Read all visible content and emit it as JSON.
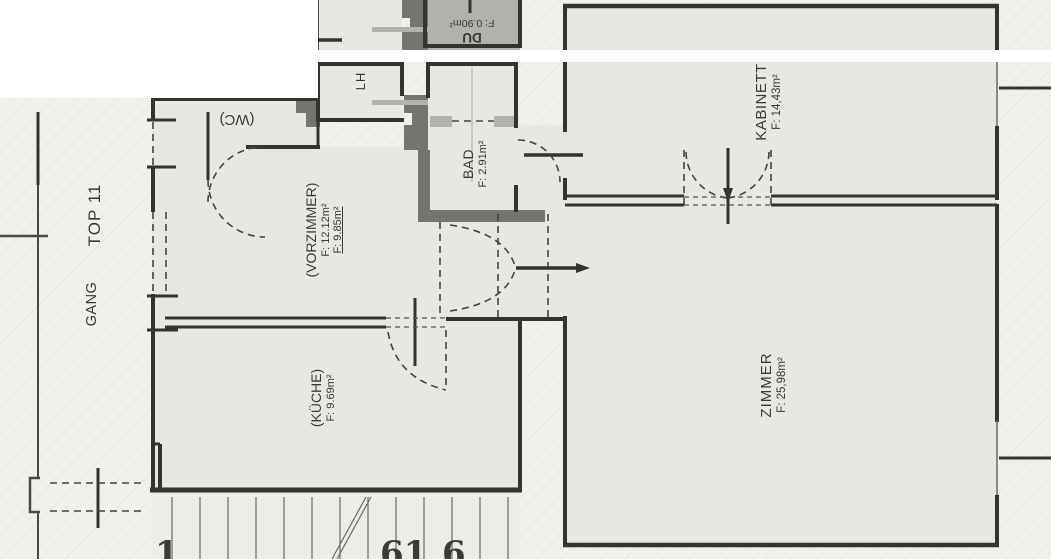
{
  "plan": {
    "unit_label": "TOP 11",
    "corridor_label": "GANG",
    "wc_area_partial": "F: 1.38m²",
    "rooms": {
      "wc": {
        "name": "(WC)"
      },
      "du": {
        "name": "DU",
        "area": "F: 0.90m²"
      },
      "lh": {
        "name": "LH"
      },
      "bad": {
        "name": "BAD",
        "area": "F: 2.91m²"
      },
      "kabinett": {
        "name": "KABINETT",
        "area": "F: 14,43m²"
      },
      "vorzimmer": {
        "name": "(VORZIMMER)",
        "area": "F: 12.12m²",
        "area2": "F: 9.85m²"
      },
      "kueche": {
        "name": "(KÜCHE)",
        "area": "F: 9.69m²"
      },
      "zimmer": {
        "name": "ZIMMER",
        "area": "F: 25,98m²"
      }
    },
    "stair_numbers": {
      "left": "1",
      "middle": "61",
      "right": "6"
    }
  },
  "colors": {
    "paper": "#f1f0ec",
    "room_fill": "#e8e7e3",
    "shower_fill": "#b3b1ac",
    "wall_black": "#35332f",
    "wall_gray": "#76746f",
    "partition_gray": "#b4b2ac",
    "scan_band": "#ffffff"
  }
}
